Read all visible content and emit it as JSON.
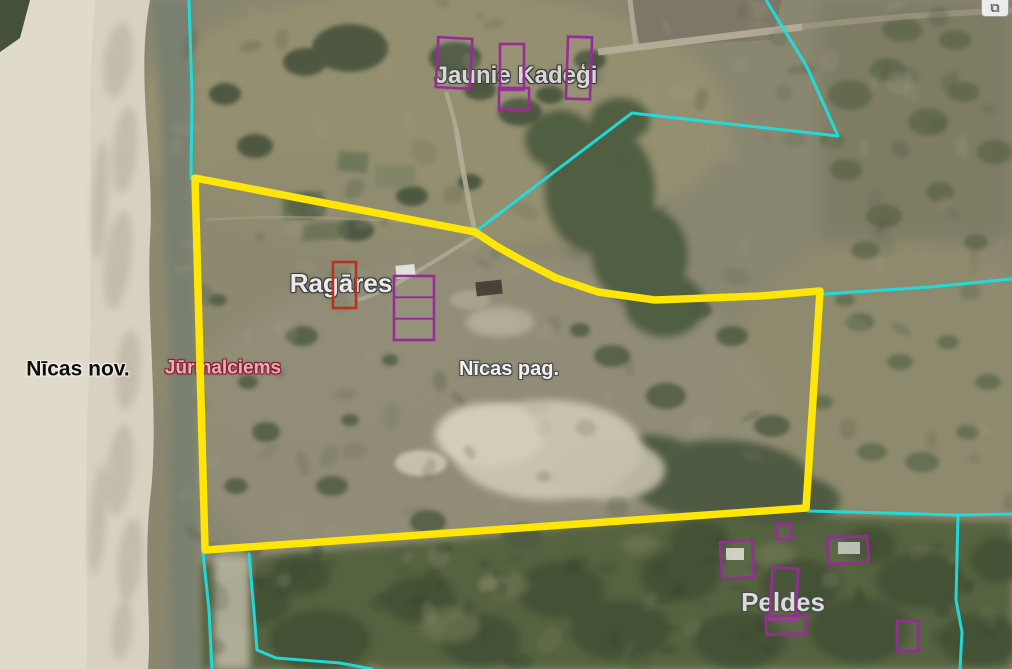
{
  "map": {
    "type": "satellite-cadastral-map",
    "labels": [
      {
        "id": "jaunie-kadegi",
        "text": "Jaunie Kadeģi",
        "x": 516,
        "y": 76,
        "size": 24,
        "bold": false,
        "color": "#d7d7d7",
        "outline": "#3a3a3a"
      },
      {
        "id": "nicas-nov",
        "text": "Nīcas nov.",
        "x": 78,
        "y": 369,
        "size": 21,
        "bold": true,
        "color": "#0d0d0d",
        "outline": "#f2efe6"
      },
      {
        "id": "jurmalciems",
        "text": "Jūrmalciems",
        "x": 223,
        "y": 368,
        "size": 19,
        "bold": true,
        "color": "#efa9b4",
        "outline": "#7c2433"
      },
      {
        "id": "ragares",
        "text": "Ragāres",
        "x": 341,
        "y": 283,
        "size": 26,
        "bold": false,
        "color": "#ebebeb",
        "outline": "#3c3c3c"
      },
      {
        "id": "nicas-pag",
        "text": "Nīcas pag.",
        "x": 509,
        "y": 369,
        "size": 20,
        "bold": true,
        "color": "#f2f2f2",
        "outline": "#4a4a4a"
      },
      {
        "id": "peldes",
        "text": "Peldes",
        "x": 783,
        "y": 602,
        "size": 26,
        "bold": false,
        "color": "#dcdcdc",
        "outline": "#464646"
      }
    ],
    "boundaries": {
      "parcel_color": "#ffe606",
      "cadastral_color": "#1bdfe0",
      "building_color": "#992b99",
      "building_alt_color": "#b5341f",
      "parcel": [
        [
          195,
          178
        ],
        [
          475,
          232
        ],
        [
          498,
          247
        ],
        [
          523,
          261
        ],
        [
          556,
          278
        ],
        [
          598,
          292
        ],
        [
          655,
          300
        ],
        [
          760,
          296
        ],
        [
          820,
          291
        ],
        [
          806,
          508
        ],
        [
          205,
          550
        ]
      ],
      "cadastral_lines": [
        [
          [
            189,
            0
          ],
          [
            192,
            95
          ],
          [
            191,
            178
          ]
        ],
        [
          [
            766,
            0
          ],
          [
            807,
            67
          ],
          [
            838,
            136
          ],
          [
            632,
            113
          ],
          [
            475,
            232
          ]
        ],
        [
          [
            824,
            294
          ],
          [
            930,
            287
          ],
          [
            1012,
            279
          ]
        ],
        [
          [
            808,
            511
          ],
          [
            958,
            515
          ],
          [
            1012,
            514
          ]
        ],
        [
          [
            958,
            515
          ],
          [
            956,
            600
          ],
          [
            962,
            632
          ],
          [
            960,
            669
          ]
        ],
        [
          [
            203,
            553
          ],
          [
            209,
            610
          ],
          [
            212,
            669
          ]
        ],
        [
          [
            249,
            554
          ],
          [
            254,
            612
          ],
          [
            257,
            650
          ],
          [
            276,
            658
          ],
          [
            340,
            663
          ],
          [
            372,
            669
          ]
        ]
      ],
      "buildings": [
        {
          "x": 437,
          "y": 38,
          "w": 34,
          "h": 50,
          "rot": 3
        },
        {
          "x": 500,
          "y": 44,
          "w": 24,
          "h": 46,
          "rot": 0
        },
        {
          "x": 567,
          "y": 37,
          "w": 24,
          "h": 62,
          "rot": 2
        },
        {
          "x": 499,
          "y": 88,
          "w": 30,
          "h": 22,
          "rot": 0
        },
        {
          "x": 333,
          "y": 262,
          "w": 23,
          "h": 46,
          "rot": 0,
          "color": "red"
        },
        {
          "x": 394,
          "y": 276,
          "w": 40,
          "h": 64,
          "rot": 0,
          "divided": true
        },
        {
          "x": 721,
          "y": 541,
          "w": 32,
          "h": 37,
          "rot": -4
        },
        {
          "x": 777,
          "y": 524,
          "w": 14,
          "h": 15,
          "rot": 0
        },
        {
          "x": 828,
          "y": 537,
          "w": 40,
          "h": 26,
          "rot": -3
        },
        {
          "x": 771,
          "y": 568,
          "w": 26,
          "h": 52,
          "rot": 3
        },
        {
          "x": 766,
          "y": 616,
          "w": 40,
          "h": 18,
          "rot": -2
        },
        {
          "x": 897,
          "y": 621,
          "w": 21,
          "h": 30,
          "rot": 0
        }
      ]
    },
    "controls": {
      "corner_button_glyph": "⧉"
    }
  }
}
